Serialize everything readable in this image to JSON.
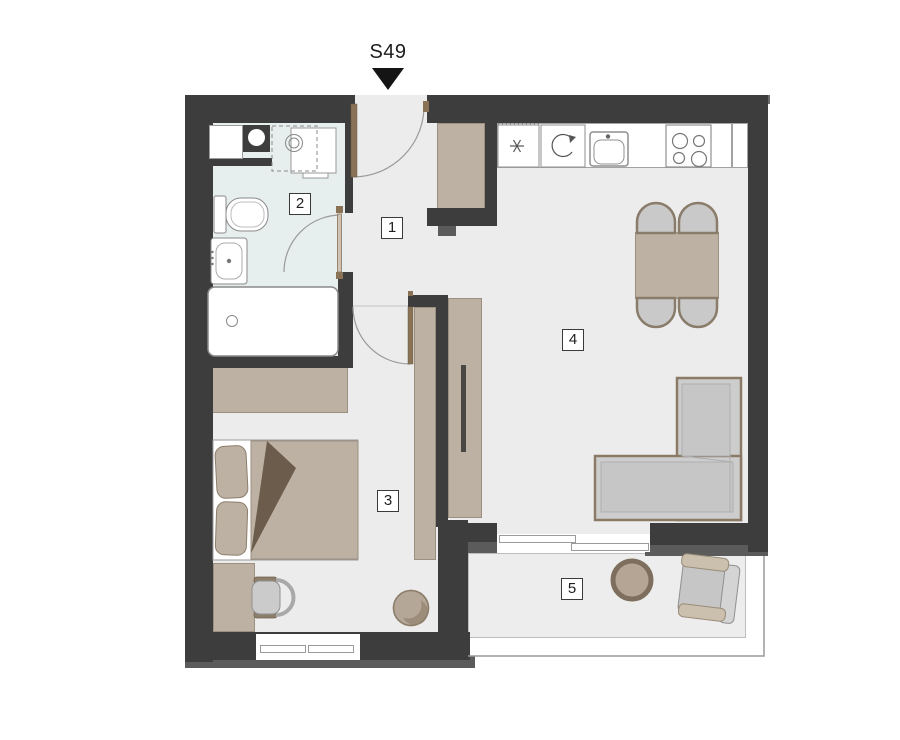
{
  "floorplan": {
    "unit_label": "S49",
    "marker_icon": "filled-down-triangle",
    "rooms": {
      "hall": "1",
      "bathroom": "2",
      "bedroom": "3",
      "living_kitchen": "4",
      "balcony": "5"
    },
    "icons": {
      "freezer": "six-point-star",
      "oven": "rotary-arrow",
      "cooktop": "four-burners",
      "vent_shaft": "circle-in-block"
    },
    "colors": {
      "wall": "#3e3d3d",
      "wall_cap": "#5c5b5b",
      "floor": "#ececec",
      "bathroom_floor": "#e7efee",
      "balcony_floor": "#ededed",
      "furniture_beige": "#bdb1a3",
      "door_brown": "#8a7257",
      "duvet_fold": "#6b5c4b",
      "sofa_gray": "#cdcdcd",
      "furniture_outline": "#8a7a66"
    }
  }
}
